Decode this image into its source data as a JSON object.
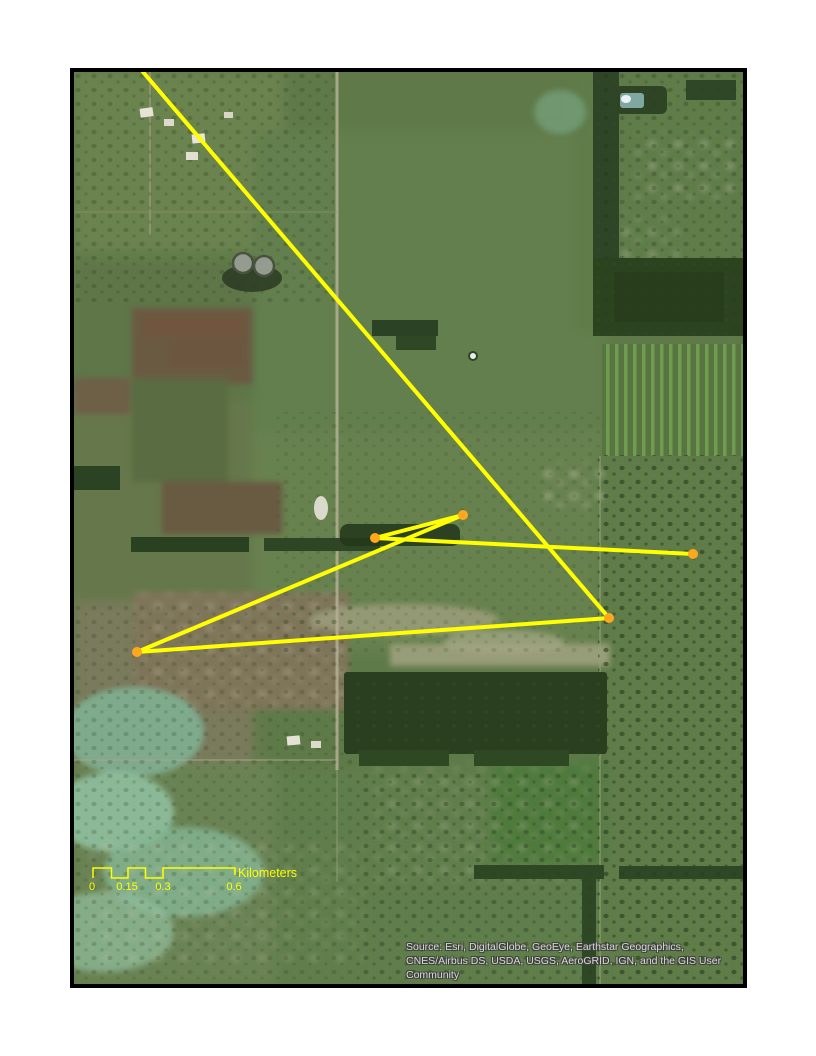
{
  "map": {
    "overlay": {
      "line_color": "#ffff00",
      "line_width": 4,
      "point_color": "#ffa81e",
      "point_radius": 5,
      "points": [
        {
          "x": 301,
          "y": 466
        },
        {
          "x": 389,
          "y": 443
        },
        {
          "x": 619,
          "y": 482
        },
        {
          "x": 535,
          "y": 546
        },
        {
          "x": 63,
          "y": 580
        }
      ],
      "lines": [
        {
          "x1": 69,
          "y1": 0,
          "x2": 535,
          "y2": 546
        },
        {
          "x1": 301,
          "y1": 466,
          "x2": 389,
          "y2": 443
        },
        {
          "x1": 301,
          "y1": 466,
          "x2": 619,
          "y2": 482
        },
        {
          "x1": 63,
          "y1": 580,
          "x2": 389,
          "y2": 443
        },
        {
          "x1": 63,
          "y1": 580,
          "x2": 535,
          "y2": 546
        }
      ]
    },
    "scale_bar": {
      "color": "#ffff00",
      "tick_labels": [
        "0",
        "0.15",
        "0.3",
        "0.6"
      ],
      "unit_label": "Kilometers"
    },
    "attribution": {
      "color": "#d9d9d9",
      "lines": [
        "Source: Esri, DigitalGlobe, GeoEye, Earthstar Geographics,",
        "CNES/Airbus DS, USDA, USGS, AeroGRID, IGN, and the GIS User",
        "Community"
      ]
    }
  }
}
